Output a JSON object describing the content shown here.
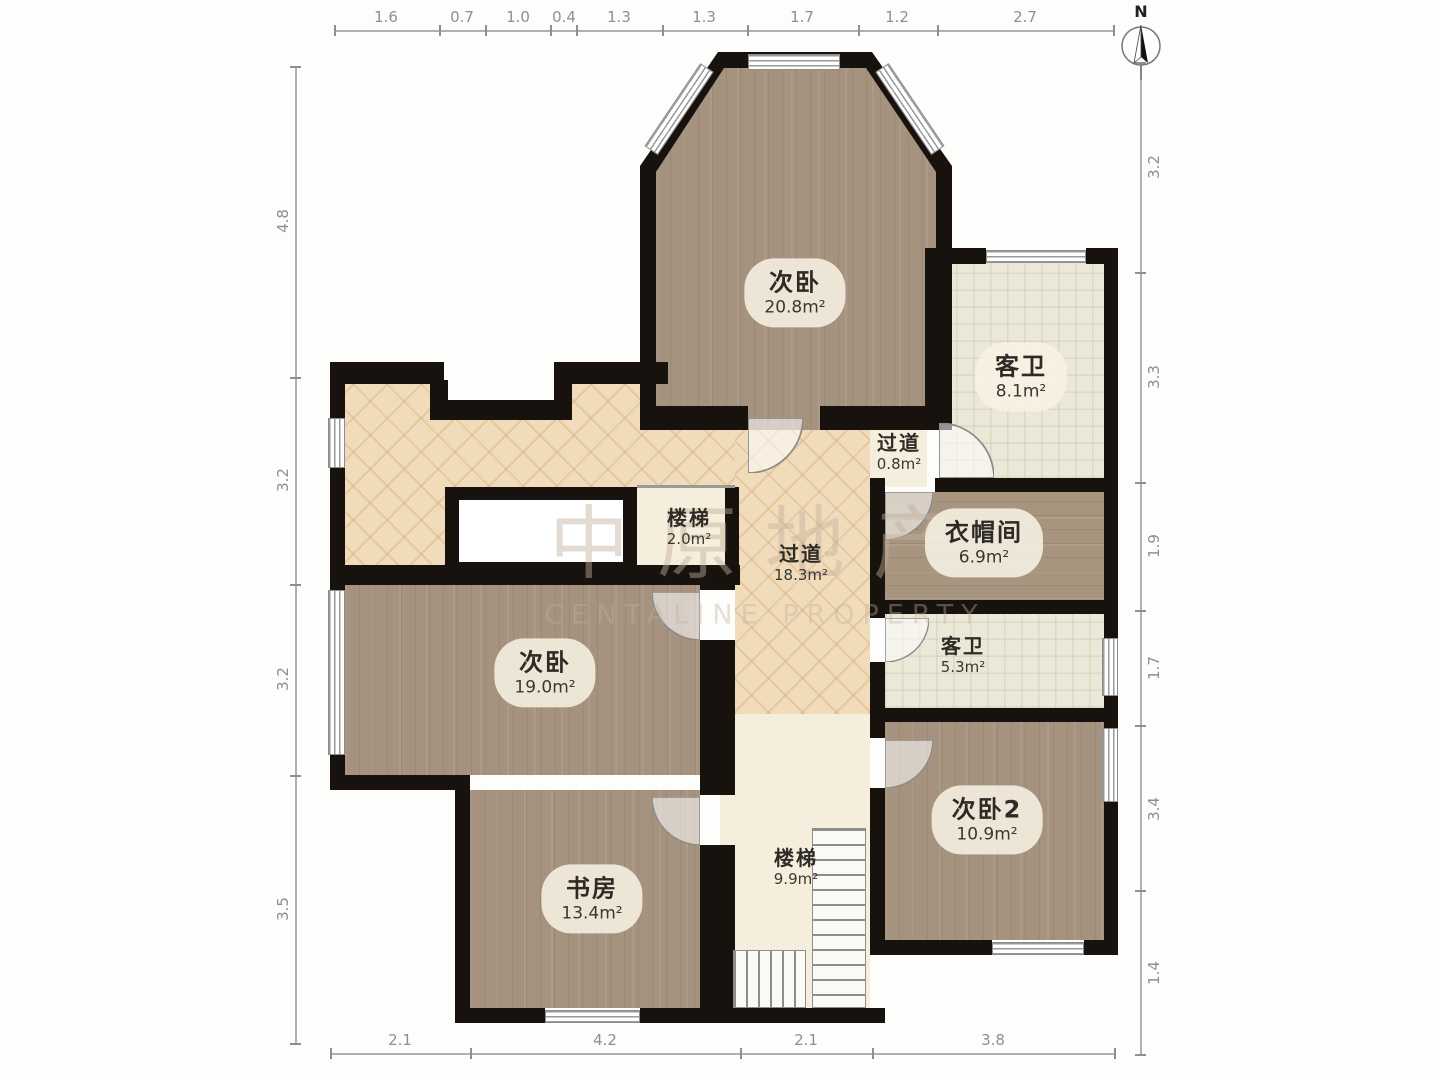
{
  "compass": {
    "north_label": "N"
  },
  "watermark": {
    "title": "中原地产",
    "subtitle": "CENTALINE PROPERTY"
  },
  "rooms": [
    {
      "name": "次卧",
      "area": "20.8m²"
    },
    {
      "name": "客卫",
      "area": "8.1m²"
    },
    {
      "name": "过道",
      "area": "0.8m²"
    },
    {
      "name": "楼梯",
      "area": "2.0m²"
    },
    {
      "name": "过道",
      "area": "18.3m²"
    },
    {
      "name": "衣帽间",
      "area": "6.9m²"
    },
    {
      "name": "客卫",
      "area": "5.3m²"
    },
    {
      "name": "次卧",
      "area": "19.0m²"
    },
    {
      "name": "次卧2",
      "area": "10.9m²"
    },
    {
      "name": "书房",
      "area": "13.4m²"
    },
    {
      "name": "楼梯",
      "area": "9.9m²"
    }
  ],
  "dimensions": {
    "top": [
      "1.6",
      "0.7",
      "1.0",
      "0.4",
      "1.3",
      "1.3",
      "1.7",
      "1.2",
      "2.7"
    ],
    "bottom": [
      "2.1",
      "4.2",
      "2.1",
      "3.8"
    ],
    "left": [
      "4.8",
      "3.2",
      "3.2",
      "3.5"
    ],
    "right": [
      "3.2",
      "3.3",
      "1.9",
      "1.7",
      "3.4",
      "1.4"
    ]
  },
  "colors": {
    "wall": "#17120d",
    "wood_floor": "#a6937f",
    "parquet_floor": "#f0dcba",
    "tile_floor": "#ece8d8",
    "stair_floor": "#f5eedc"
  }
}
